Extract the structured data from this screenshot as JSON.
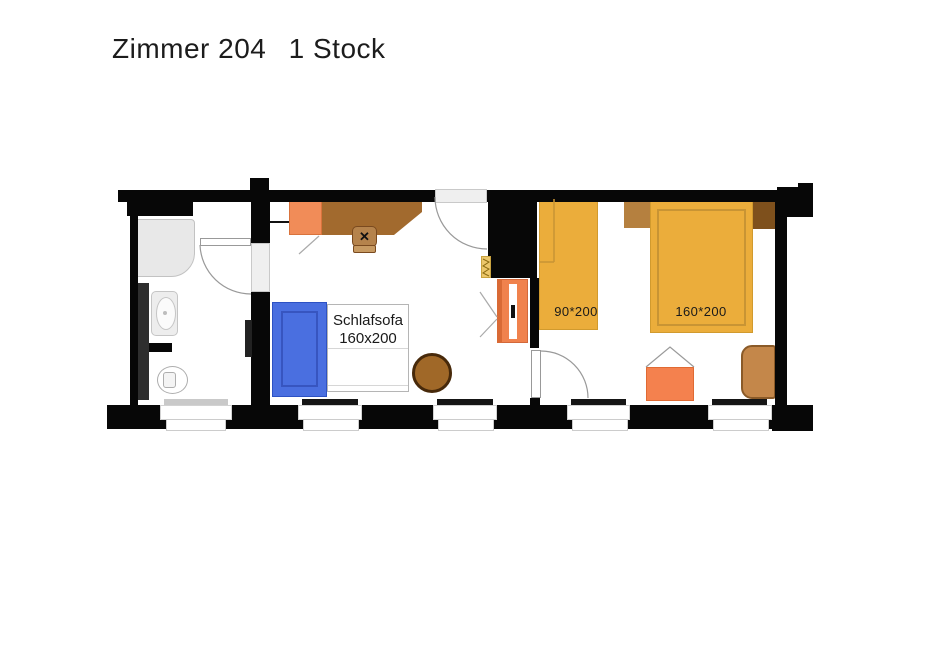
{
  "title": {
    "room": "Zimmer 204",
    "floor": "1 Stock"
  },
  "labels": {
    "sofa_line1": "Schlafsofa",
    "sofa_line2": "160x200",
    "bed_single": "90*200",
    "bed_double": "160*200"
  },
  "colors": {
    "wall": "#070707",
    "shower_gray": "#E8E8E8",
    "sofa_blue": "#4A6FE0",
    "dresser_orange": "#F18C58",
    "wardrobe_orange": "#F0824D",
    "wardrobe_edge": "#D96A35",
    "rack_orange": "#F4814E",
    "desk_brown": "#A26A2E",
    "chair_brown": "#B5834C",
    "chair_flap": "#C79A62",
    "table_brown": "#A06828",
    "bed_yellow": "#EBAD3B",
    "headboard_left_brown": "#B5803F",
    "headboard_right_brown": "#7E501C",
    "armchair_brown": "#C4874A"
  }
}
